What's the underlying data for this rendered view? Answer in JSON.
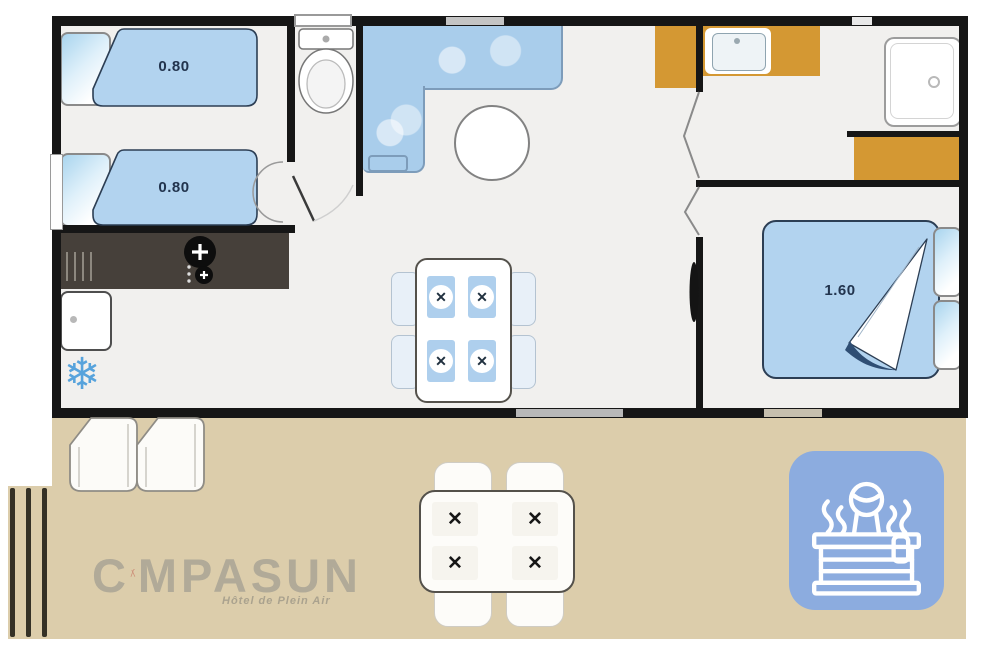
{
  "plan": {
    "labels": {
      "twin_bed_1": "0.80",
      "twin_bed_2": "0.80",
      "double_bed": "1.60"
    }
  },
  "branding": {
    "logo_full": "CAMPASUN",
    "logo_prefix": "C",
    "logo_suffix": "MPASUN",
    "tagline": "Hôtel de Plein Air"
  },
  "icons": {
    "freezer_glyph": "❄",
    "place_setting_glyph": "✕",
    "hot_tub_icon": "person-in-hot-tub",
    "tent_icon": "tent-letter-a"
  },
  "colors": {
    "wall": "#161616",
    "floor": "#f1f0ee",
    "bed_blue": "#b2d3ef",
    "counter_blue": "#a9cdeb",
    "cabinet_orange": "#d49833",
    "dark_counter": "#46403a",
    "terrace_tan": "#dccdab",
    "spa_tile_blue": "#8cacdf",
    "logo_red": "#bf584c",
    "freezer_blue": "#57a3dc"
  }
}
